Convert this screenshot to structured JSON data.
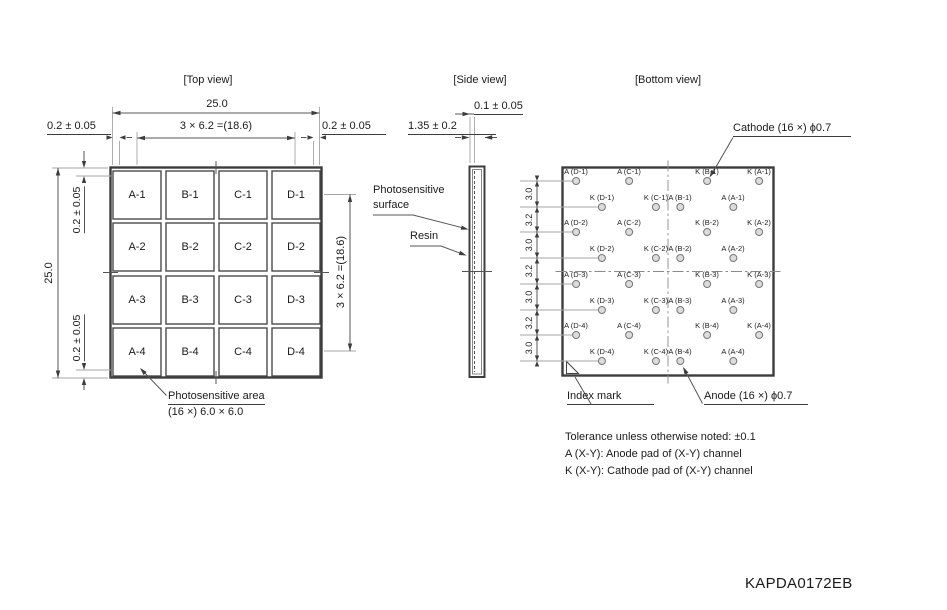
{
  "titles": {
    "top_view": "[Top view]",
    "side_view": "[Side view]",
    "bottom_view": "[Bottom view]"
  },
  "top_view": {
    "dim_width": "25.0",
    "dim_pitch_h": "3 × 6.2 =(18.6)",
    "dim_margin_left": "0.2 ± 0.05",
    "dim_margin_right": "0.2 ± 0.05",
    "dim_height": "25.0",
    "dim_margin_top": "0.2 ± 0.05",
    "dim_margin_bottom": "0.2 ± 0.05",
    "dim_pitch_v": "3 × 6.2 =(18.6)",
    "cells": [
      "A-1",
      "B-1",
      "C-1",
      "D-1",
      "A-2",
      "B-2",
      "C-2",
      "D-2",
      "A-3",
      "B-3",
      "C-3",
      "D-3",
      "A-4",
      "B-4",
      "C-4",
      "D-4"
    ],
    "area_note_line1": "Photosensitive area",
    "area_note_line2": "(16 ×) 6.0 × 6.0"
  },
  "side_view": {
    "dim_surface": "0.1 ± 0.05",
    "dim_thickness": "1.35 ± 0.2",
    "label_surface_line1": "Photosensitive",
    "label_surface_line2": "surface",
    "label_resin": "Resin"
  },
  "bottom_view": {
    "cathode_label": "Cathode (16 ×) ϕ0.7",
    "anode_label": "Anode (16 ×) ϕ0.7",
    "index_label": "Index mark",
    "pitch_labels": [
      "3.0",
      "3.2",
      "3.0",
      "3.2",
      "3.0",
      "3.2",
      "3.0"
    ],
    "pads": [
      "A (D-1)",
      "A (C-1)",
      "K (B-1)",
      "K (A-1)",
      "K (D-1)",
      "K (C-1)",
      "A (B-1)",
      "A (A-1)",
      "A (D-2)",
      "A (C-2)",
      "K (B-2)",
      "K (A-2)",
      "K (D-2)",
      "K (C-2)",
      "A (B-2)",
      "A (A-2)",
      "A (D-3)",
      "A (C-3)",
      "K (B-3)",
      "K (A-3)",
      "K (D-3)",
      "K (C-3)",
      "A (B-3)",
      "A (A-3)",
      "A (D-4)",
      "A (C-4)",
      "K (B-4)",
      "K (A-4)",
      "K (D-4)",
      "K (C-4)",
      "A (B-4)",
      "A (A-4)"
    ]
  },
  "notes": [
    "Tolerance unless otherwise noted: ±0.1",
    "A (X-Y): Anode pad of (X-Y) channel",
    "K (X-Y): Cathode pad of (X-Y) channel"
  ],
  "doc_number": "KAPDA0172EB"
}
